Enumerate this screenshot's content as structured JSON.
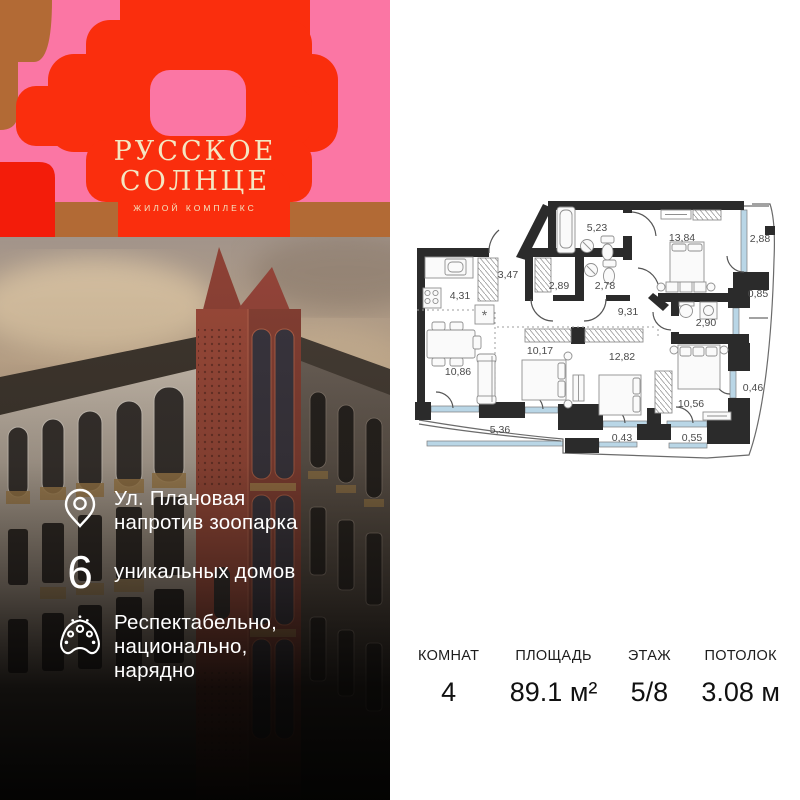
{
  "brand": {
    "title_line1": "РУССКОЕ",
    "title_line2": "СОЛНЦЕ",
    "subtitle": "жилой комплекс"
  },
  "palette": {
    "accent_red": "#fa2e0d",
    "accent_pink": "#fb76a4",
    "accent_brown": "#b26a35",
    "cream_text": "#f4e6c2"
  },
  "features": {
    "items": [
      {
        "icon": "location-pin-icon",
        "text": "Ул. Плановая\nнапротив зоопарка"
      },
      {
        "icon": "numeral-six",
        "number": "6",
        "text": "уникальных домов"
      },
      {
        "icon": "kokoshnik-icon",
        "text": "Респектабельно,\nнационально,\nнарядно"
      }
    ]
  },
  "floorplan": {
    "rooms": [
      {
        "name": "kitchen",
        "area": "4,31"
      },
      {
        "name": "hallway",
        "area": "3,47"
      },
      {
        "name": "bathroom-main",
        "area": "5,23"
      },
      {
        "name": "wardrobe-room",
        "area": "2,89"
      },
      {
        "name": "bathroom-guest",
        "area": "2,78"
      },
      {
        "name": "bedroom-1",
        "area": "13,84"
      },
      {
        "name": "loggia-top",
        "area": "2,88"
      },
      {
        "name": "loggia-small",
        "area": "0,85"
      },
      {
        "name": "corridor",
        "area": "9,31"
      },
      {
        "name": "bathroom-small",
        "area": "2,90"
      },
      {
        "name": "living-room",
        "area": "10,86"
      },
      {
        "name": "bedroom-2",
        "area": "10,17"
      },
      {
        "name": "bedroom-3",
        "area": "12,82"
      },
      {
        "name": "bedroom-4",
        "area": "10,56"
      },
      {
        "name": "loggia-right",
        "area": "0,46"
      },
      {
        "name": "balcony-bottom",
        "area": "5,36"
      },
      {
        "name": "balcony-small-1",
        "area": "0,43"
      },
      {
        "name": "balcony-small-2",
        "area": "0,55"
      }
    ]
  },
  "stats": {
    "items": [
      {
        "label": "КОМНАТ",
        "value": "4"
      },
      {
        "label": "ПЛОЩАДЬ",
        "value": "89.1 м²"
      },
      {
        "label": "ЭТАЖ",
        "value": "5/8"
      },
      {
        "label": "ПОТОЛОК",
        "value": "3.08 м"
      }
    ]
  }
}
